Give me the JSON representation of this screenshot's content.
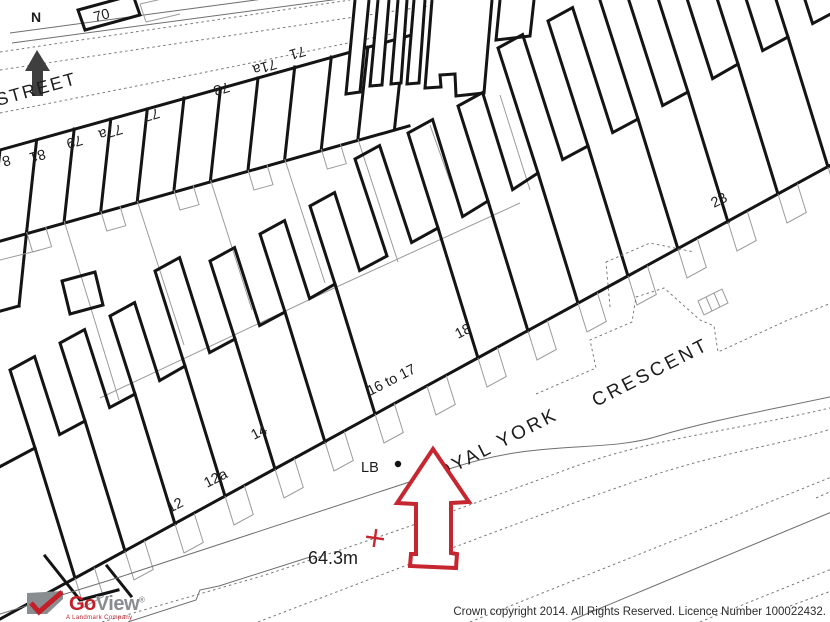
{
  "map": {
    "compass": {
      "label": "N"
    },
    "streets": {
      "top_street": "STREET",
      "crescent_line1": "ROYAL YORK",
      "crescent_line2": "CRESCENT"
    },
    "house_numbers": [
      {
        "text": "70"
      },
      {
        "text": "8"
      },
      {
        "text": "81"
      },
      {
        "text": "79"
      },
      {
        "text": "77a"
      },
      {
        "text": "77"
      },
      {
        "text": "73"
      },
      {
        "text": "71a"
      },
      {
        "text": "71"
      },
      {
        "text": "23"
      },
      {
        "text": "18"
      },
      {
        "text": "16 to 17"
      },
      {
        "text": "14"
      },
      {
        "text": "12a"
      },
      {
        "text": "12"
      }
    ],
    "annotations": {
      "letter_box": "LB",
      "spot_height": "64.3m"
    },
    "marker_color": "#c62630"
  },
  "branding": {
    "go": "Go",
    "view": "View",
    "registered": "®",
    "tagline": "A Landmark Company",
    "red": "#c41e28",
    "gray": "#8a8d90"
  },
  "footer": {
    "copyright": "Crown copyright 2014. All Rights Reserved. Licence Number 100022432."
  }
}
